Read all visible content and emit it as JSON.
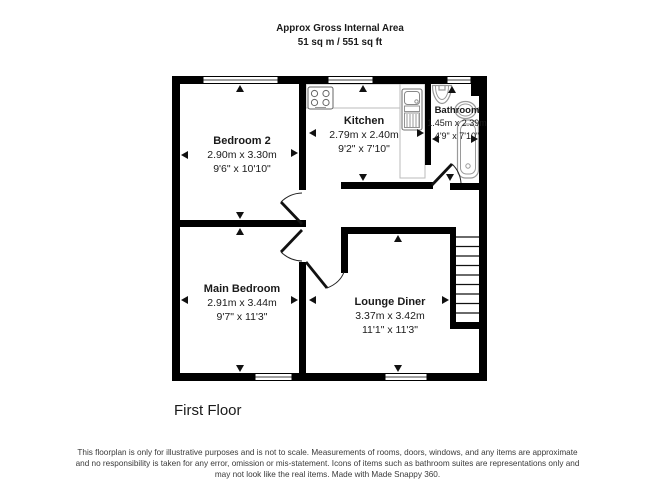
{
  "header": {
    "line1": "Approx Gross Internal Area",
    "line2": "51 sq m / 551 sq ft"
  },
  "rooms": [
    {
      "name": "Bedroom 2",
      "metric": "2.90m x 3.30m",
      "imperial": "9'6\" x 10'10\""
    },
    {
      "name": "Kitchen",
      "metric": "2.79m x 2.40m",
      "imperial": "9'2\" x 7'10\""
    },
    {
      "name": "Bathroom",
      "metric": "1.45m x 2.39m",
      "imperial": "4'9\" x 7'10\""
    },
    {
      "name": "Main Bedroom",
      "metric": "2.91m x 3.44m",
      "imperial": "9'7\" x 11'3\""
    },
    {
      "name": "Lounge Diner",
      "metric": "3.37m x 3.42m",
      "imperial": "11'1\" x 11'3\""
    }
  ],
  "floor_label": "First Floor",
  "disclaimer": {
    "line1": "This floorplan is only for illustrative purposes and is not to scale. Measurements of rooms, doors, windows, and any items are approximate",
    "line2": "and no responsibility is taken for any error, omission or mis-statement. Icons of items such as bathroom suites are representations only and",
    "line3": "may not look like the real items. Made with Made Snappy 360."
  },
  "colors": {
    "wall": "#000000",
    "fixture": "#9a9a9a",
    "counter": "#bbbbbb",
    "text": "#1a1a1a",
    "disclaimer": "#3a3a3a",
    "background": "#ffffff"
  }
}
